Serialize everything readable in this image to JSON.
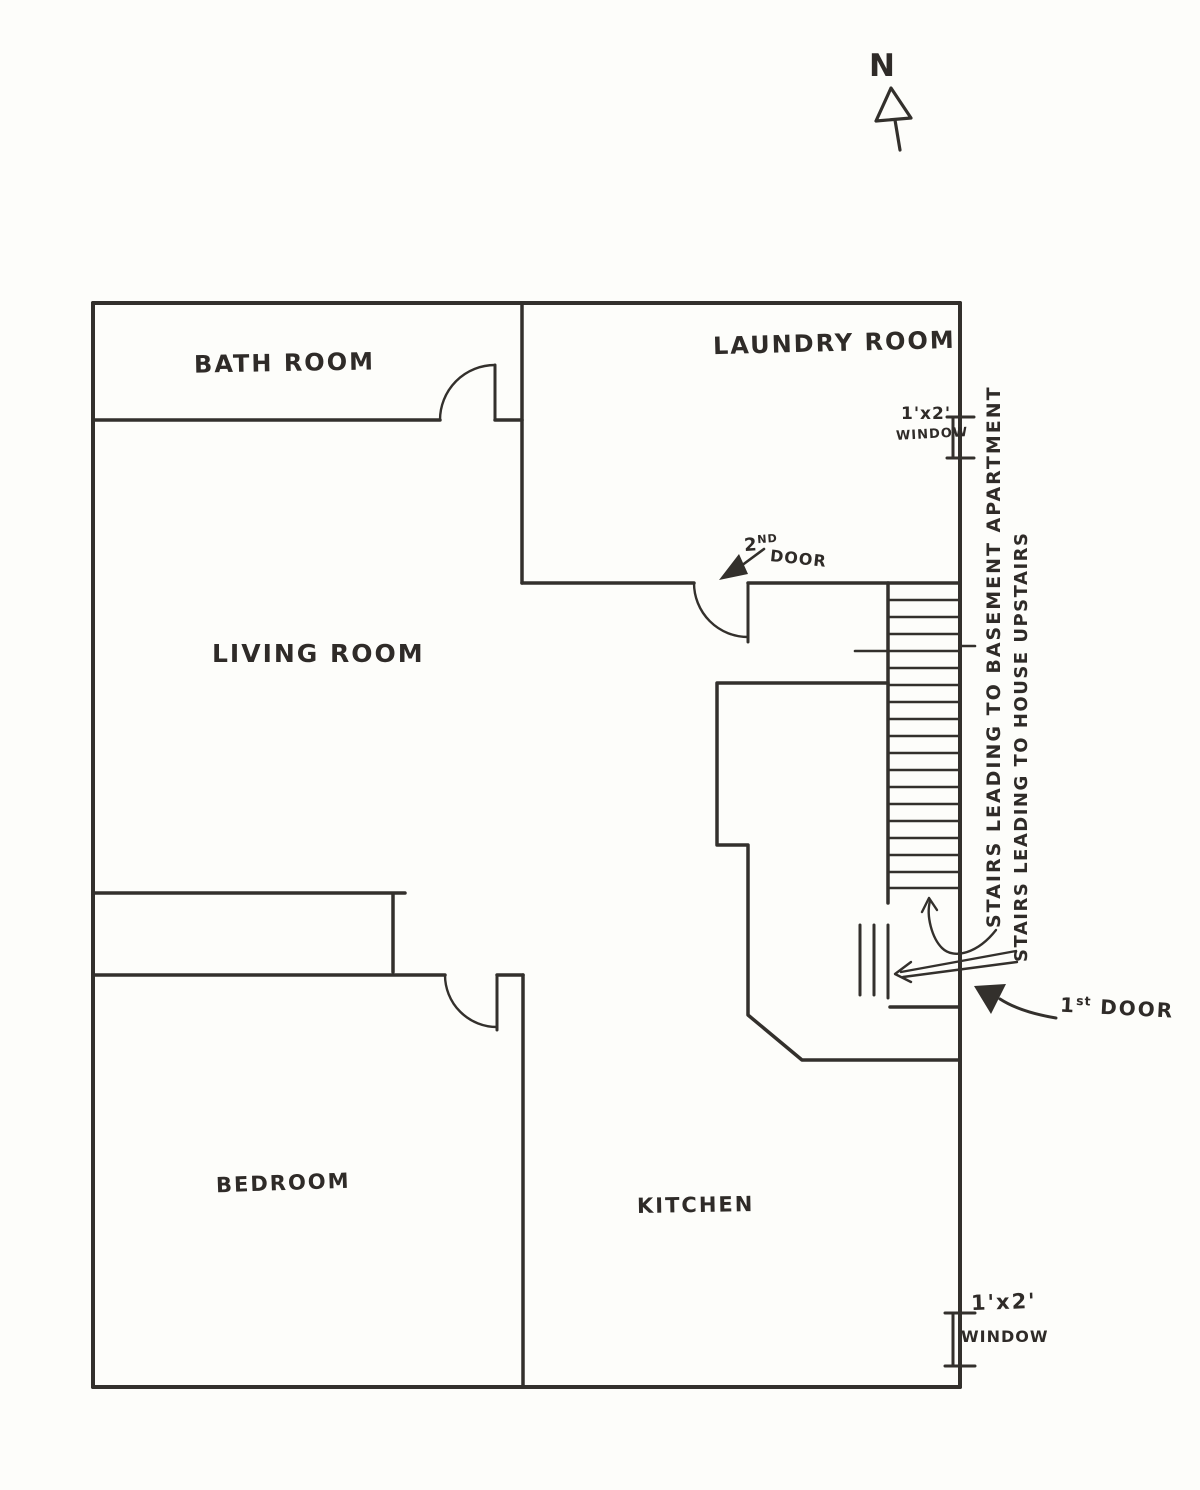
{
  "compass": {
    "label": "N"
  },
  "rooms": {
    "bathroom": "BATH ROOM",
    "laundry": "LAUNDRY ROOM",
    "living": "LIVING ROOM",
    "bedroom": "BEDROOM",
    "kitchen": "KITCHEN"
  },
  "windows": {
    "top": {
      "size": "1'x2'",
      "word": "WINDOW"
    },
    "bottom": {
      "size": "1'x2'",
      "word": "WINDOW"
    }
  },
  "doors": {
    "first": {
      "num": "1",
      "sup": "st",
      "word": "DOOR"
    },
    "second": {
      "num": "2",
      "sup": "ND",
      "word": "DOOR"
    }
  },
  "stairs": {
    "basement": "STAIRS LEADING TO BASEMENT APARTMENT",
    "upstairs": "STAIRS LEADING TO HOUSE UPSTAIRS"
  },
  "colors": {
    "ink": "#33302c",
    "paper": "#fdfdfa"
  }
}
